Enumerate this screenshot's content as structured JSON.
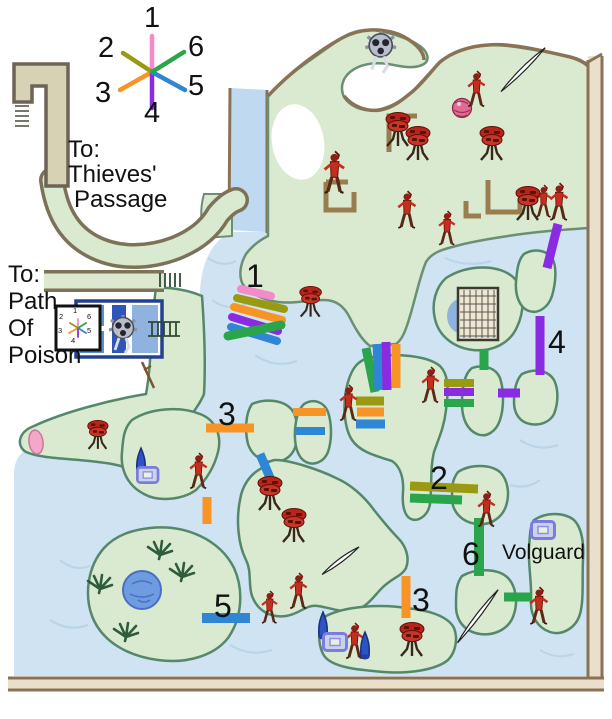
{
  "palette": {
    "water": "#cfe3f2",
    "water_texture": "#b7d2e8",
    "land": "#d9ead0",
    "land_edge": "#5f8f72",
    "dirt": "#8a7355",
    "frame_fill": "#e9dfcb",
    "corridor_fill": "#d6d2b4",
    "room_blue": "#2f55b8",
    "text": "#111111"
  },
  "legend": {
    "items": [
      {
        "number": "1",
        "color": "#f28bc8",
        "direction": "north"
      },
      {
        "number": "2",
        "color": "#9a9a12",
        "direction": "northwest"
      },
      {
        "number": "3",
        "color": "#f89325",
        "direction": "southwest"
      },
      {
        "number": "4",
        "color": "#8a2be2",
        "direction": "south"
      },
      {
        "number": "5",
        "color": "#2e86d4",
        "direction": "southeast"
      },
      {
        "number": "6",
        "color": "#2aa54c",
        "direction": "northeast"
      }
    ]
  },
  "route_colors": {
    "r1": "#f28bc8",
    "r2": "#9a9a12",
    "r3": "#f89325",
    "r4": "#8a2be2",
    "r5": "#2e86d4",
    "r6": "#2aa54c"
  },
  "labels": {
    "thieves": {
      "l1": "To:",
      "l2": "Thieves'",
      "l3": "Passage"
    },
    "poison": {
      "l1": "To:",
      "l2": "Path",
      "l3": "Of",
      "l4": "Poison"
    },
    "volguard": "Volguard"
  },
  "markers": [
    {
      "label": "1"
    },
    {
      "label": "3"
    },
    {
      "label": "2"
    },
    {
      "label": "4"
    },
    {
      "label": "5"
    },
    {
      "label": "6"
    },
    {
      "label": "3"
    }
  ],
  "icons": {
    "warrior": "red-warrior-sprite",
    "mushroom": "red-mushroom-creature-sprite",
    "gear": "grey-gear-creature-sprite",
    "orb": "pink-orb",
    "needle": "white-needle",
    "cone": "blue-cone-tree",
    "chest": "blue-chest",
    "palm": "palm-tree",
    "pond": "blue-pond",
    "oval": "pink-oval",
    "dagger": "dagger"
  }
}
